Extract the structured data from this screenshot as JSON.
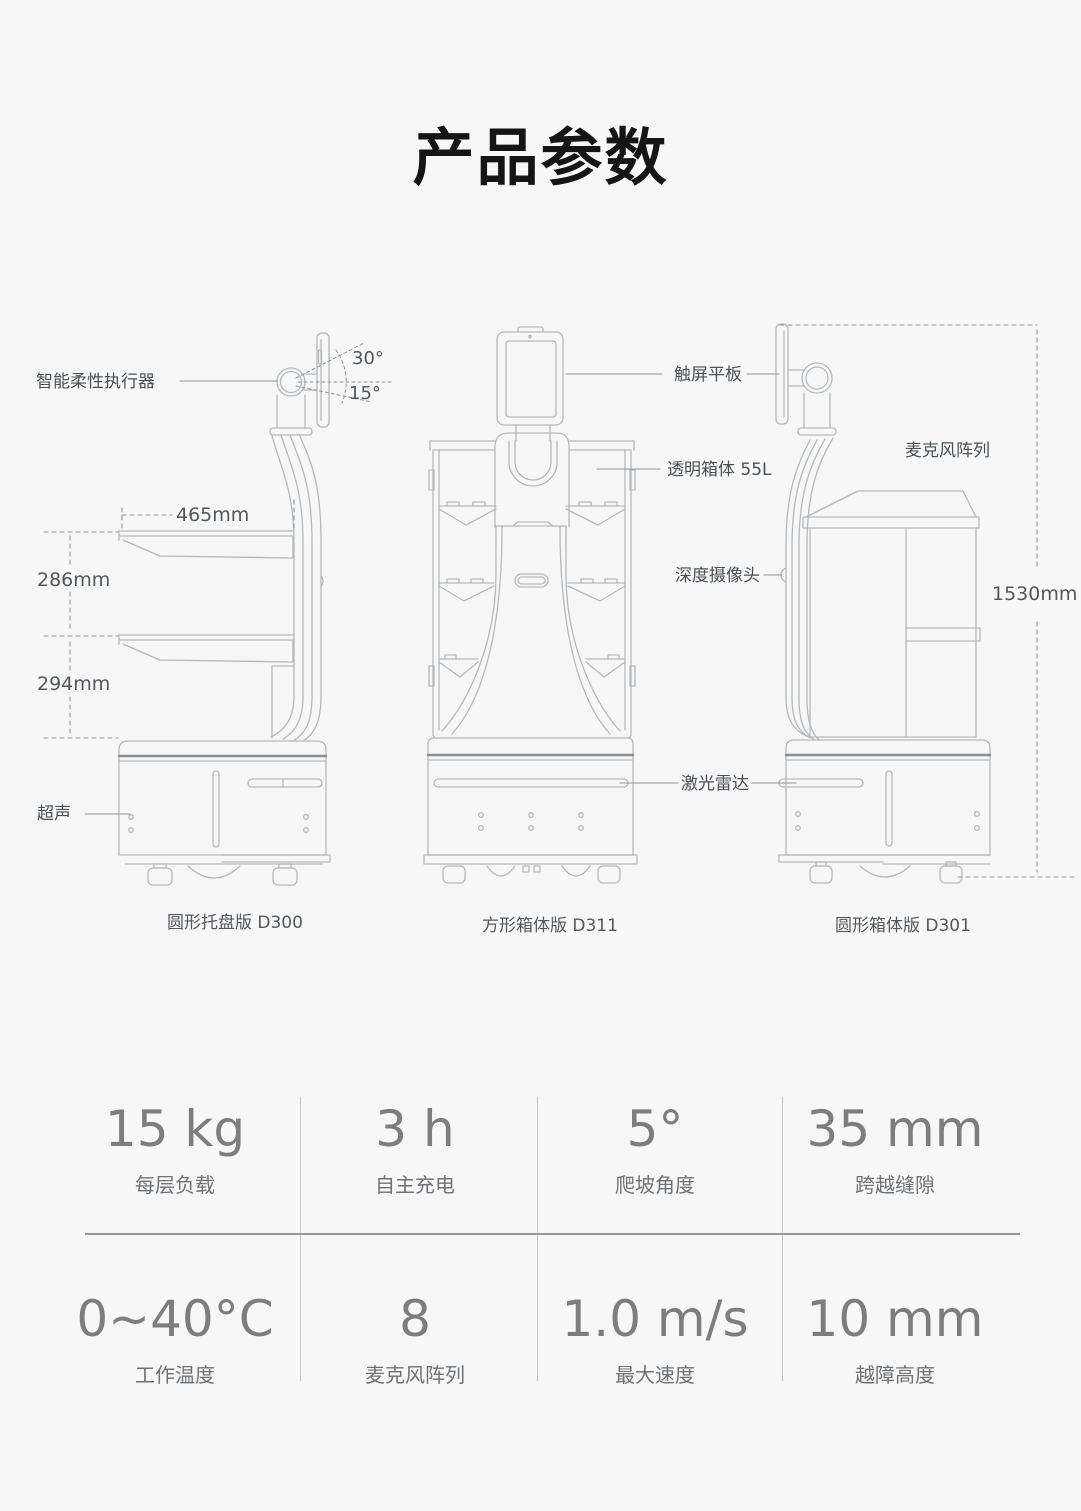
{
  "title": "产品参数",
  "diagram": {
    "labels": {
      "actuator": "智能柔性执行器",
      "tilt_up": "30°",
      "tilt_down": "15°",
      "tray_width": "465mm",
      "tray_gap_upper": "286mm",
      "tray_gap_lower": "294mm",
      "ultrasonic": "超声",
      "touchscreen": "触屏平板",
      "transparent_cabinet": "透明箱体 55L",
      "depth_camera": "深度摄像头",
      "lidar": "激光雷达",
      "mic_array": "麦克风阵列",
      "total_height": "1530mm"
    },
    "captions": {
      "left": "圆形托盘版 D300",
      "middle": "方形箱体版 D311",
      "right": "圆形箱体版 D301"
    }
  },
  "specs": [
    {
      "value": "15 kg",
      "label": "每层负载"
    },
    {
      "value": "3 h",
      "label": "自主充电"
    },
    {
      "value": "5°",
      "label": "爬坡角度"
    },
    {
      "value": "35 mm",
      "label": "跨越缝隙"
    },
    {
      "value": "0~40°C",
      "label": "工作温度"
    },
    {
      "value": "8",
      "label": "麦克风阵列"
    },
    {
      "value": "1.0 m/s",
      "label": "最大速度"
    },
    {
      "value": "10 mm",
      "label": "越障高度"
    }
  ],
  "colors": {
    "background": "#f7f7f8",
    "line_art": "#b5b9bb",
    "dark_band": "#8b8f91",
    "annotation_line": "#8f9598",
    "label_text": "#4b5054",
    "spec_value_text": "#7d7d7e",
    "divider": "#c6c7c8"
  }
}
